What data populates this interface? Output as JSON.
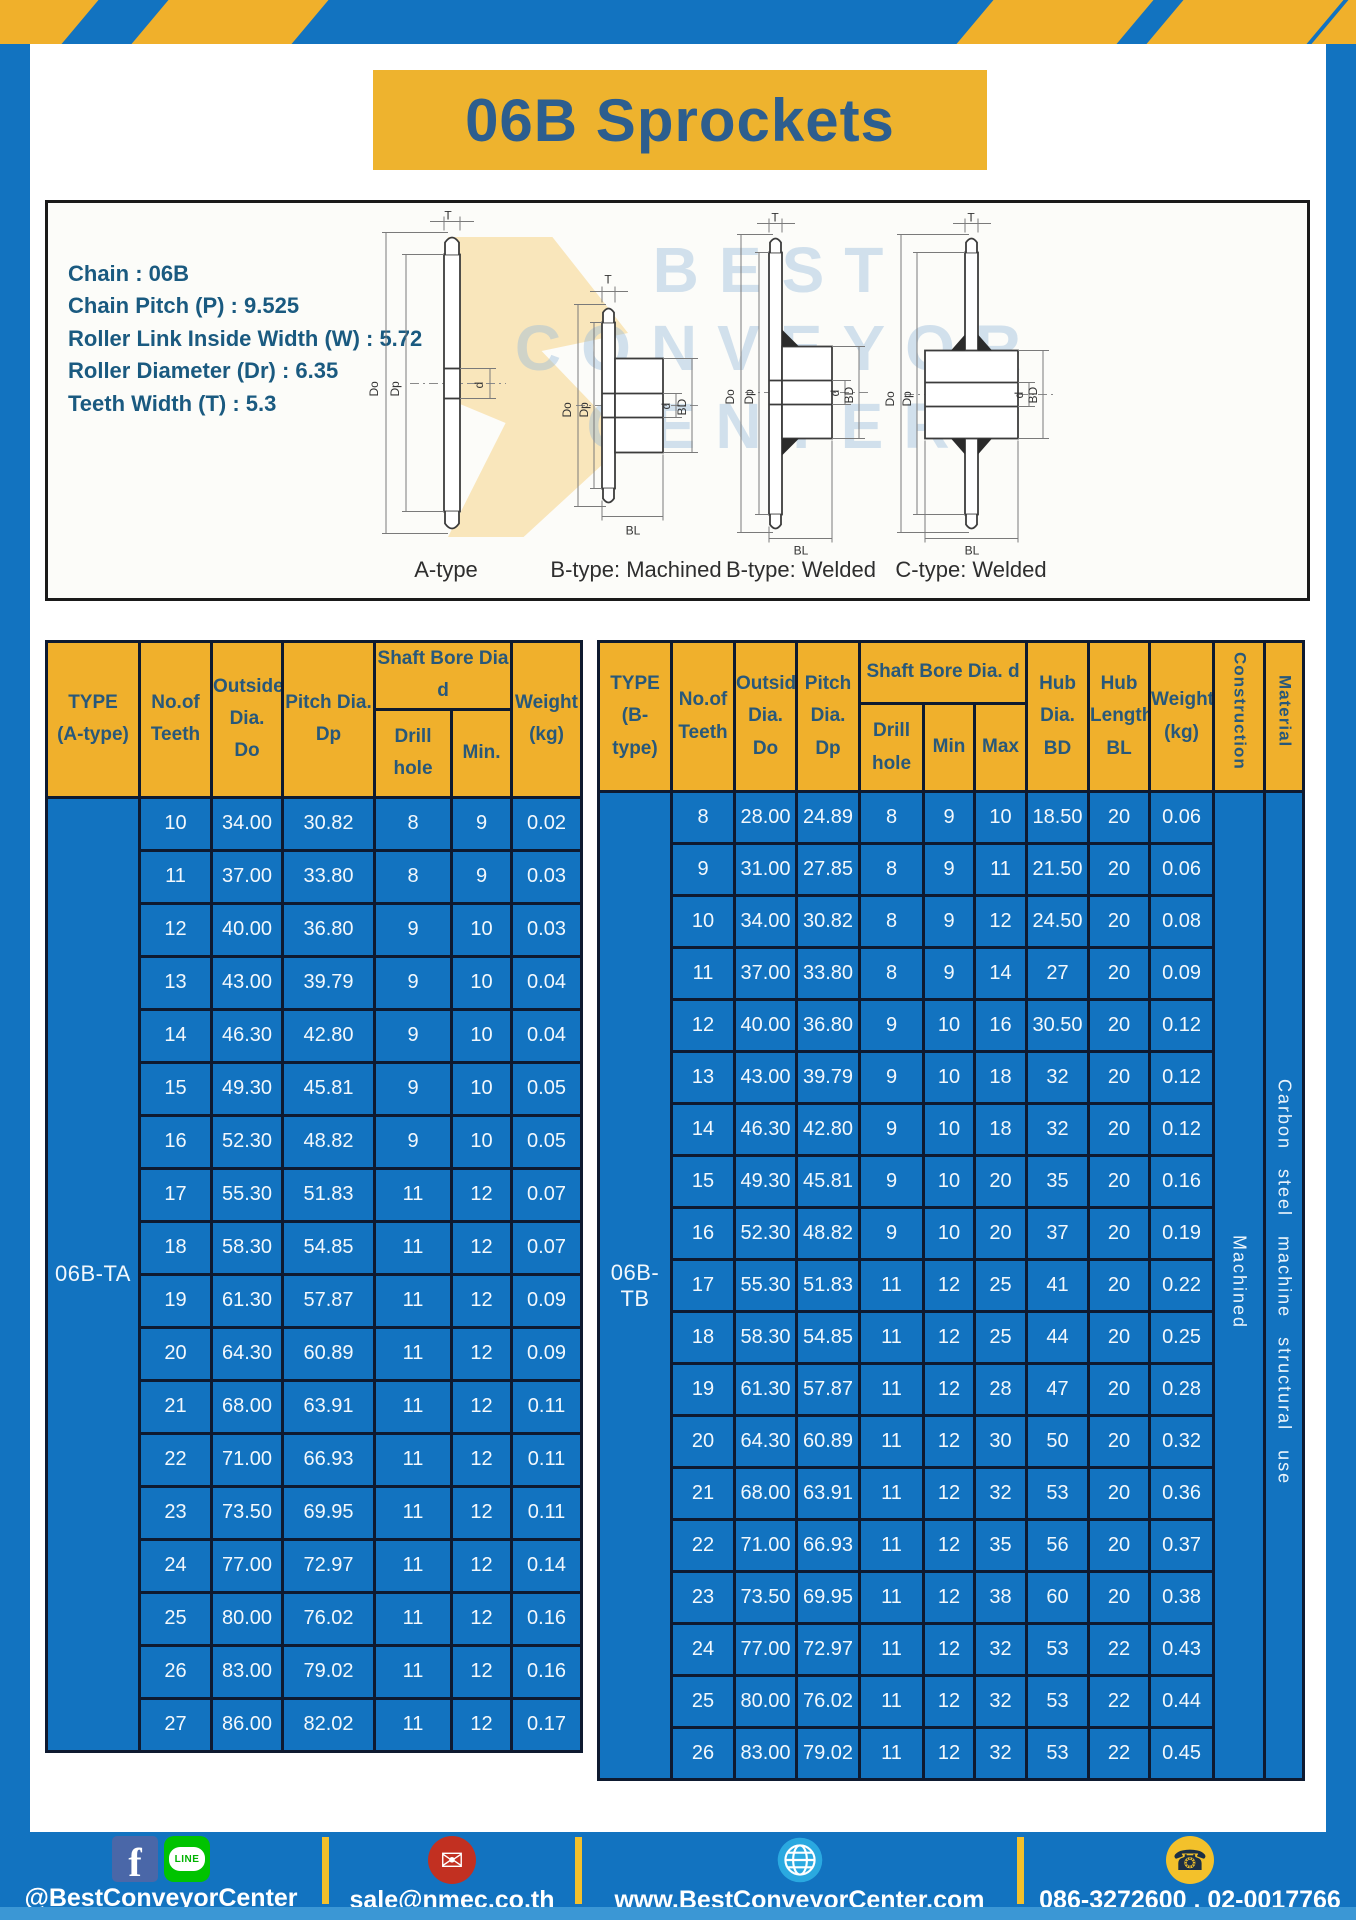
{
  "title": {
    "text": "06B Sprockets"
  },
  "specs": {
    "lines": [
      "Chain : 06B",
      "Chain Pitch (P) : 9.525",
      "Roller Link Inside Width (W) : 5.72",
      "Roller Diameter (Dr) : 6.35",
      "Teeth Width (T) : 5.3"
    ]
  },
  "watermark": {
    "lines": [
      "BEST",
      "CONVEYOR",
      "CENTER"
    ]
  },
  "diagrams": {
    "captions": [
      "A-type",
      "B-type: Machined",
      "B-type: Welded",
      "C-type: Welded"
    ],
    "dim_labels": {
      "t": "T",
      "do": "Do",
      "dp": "Dp",
      "d": "d",
      "bd": "BD",
      "bl": "BL"
    }
  },
  "table_a": {
    "type_label": "06B-TA",
    "headers": {
      "type": "TYPE\n(A-type)",
      "teeth": "No.of\nTeeth",
      "outside": "Outside\nDia.\nDo",
      "pitch": "Pitch Dia.\nDp",
      "shaft": "Shaft Bore Dia d",
      "drill": "Drill hole",
      "min": "Min.",
      "weight": "Weight\n(kg)"
    },
    "rows": [
      [
        "10",
        "34.00",
        "30.82",
        "8",
        "9",
        "0.02"
      ],
      [
        "11",
        "37.00",
        "33.80",
        "8",
        "9",
        "0.03"
      ],
      [
        "12",
        "40.00",
        "36.80",
        "9",
        "10",
        "0.03"
      ],
      [
        "13",
        "43.00",
        "39.79",
        "9",
        "10",
        "0.04"
      ],
      [
        "14",
        "46.30",
        "42.80",
        "9",
        "10",
        "0.04"
      ],
      [
        "15",
        "49.30",
        "45.81",
        "9",
        "10",
        "0.05"
      ],
      [
        "16",
        "52.30",
        "48.82",
        "9",
        "10",
        "0.05"
      ],
      [
        "17",
        "55.30",
        "51.83",
        "11",
        "12",
        "0.07"
      ],
      [
        "18",
        "58.30",
        "54.85",
        "11",
        "12",
        "0.07"
      ],
      [
        "19",
        "61.30",
        "57.87",
        "11",
        "12",
        "0.09"
      ],
      [
        "20",
        "64.30",
        "60.89",
        "11",
        "12",
        "0.09"
      ],
      [
        "21",
        "68.00",
        "63.91",
        "11",
        "12",
        "0.11"
      ],
      [
        "22",
        "71.00",
        "66.93",
        "11",
        "12",
        "0.11"
      ],
      [
        "23",
        "73.50",
        "69.95",
        "11",
        "12",
        "0.11"
      ],
      [
        "24",
        "77.00",
        "72.97",
        "11",
        "12",
        "0.14"
      ],
      [
        "25",
        "80.00",
        "76.02",
        "11",
        "12",
        "0.16"
      ],
      [
        "26",
        "83.00",
        "79.02",
        "11",
        "12",
        "0.16"
      ],
      [
        "27",
        "86.00",
        "82.02",
        "11",
        "12",
        "0.17"
      ]
    ]
  },
  "table_b": {
    "type_label": "06B-TB",
    "construction_value": "Machined",
    "material_value": "Carbon steel machine structural use",
    "headers": {
      "type": "TYPE\n(B-type)",
      "teeth": "No.of\nTeeth",
      "outside": "Outside\nDia.\nDo",
      "pitch": "Pitch\nDia.\nDp",
      "shaft": "Shaft Bore Dia. d",
      "drill": "Drill hole",
      "min": "Min",
      "max": "Max",
      "hub_dia": "Hub\nDia.\nBD",
      "hub_len": "Hub\nLength\nBL",
      "weight": "Weight\n(kg)",
      "construction": "Construction",
      "material": "Material"
    },
    "rows": [
      [
        "8",
        "28.00",
        "24.89",
        "8",
        "9",
        "10",
        "18.50",
        "20",
        "0.06"
      ],
      [
        "9",
        "31.00",
        "27.85",
        "8",
        "9",
        "11",
        "21.50",
        "20",
        "0.06"
      ],
      [
        "10",
        "34.00",
        "30.82",
        "8",
        "9",
        "12",
        "24.50",
        "20",
        "0.08"
      ],
      [
        "11",
        "37.00",
        "33.80",
        "8",
        "9",
        "14",
        "27",
        "20",
        "0.09"
      ],
      [
        "12",
        "40.00",
        "36.80",
        "9",
        "10",
        "16",
        "30.50",
        "20",
        "0.12"
      ],
      [
        "13",
        "43.00",
        "39.79",
        "9",
        "10",
        "18",
        "32",
        "20",
        "0.12"
      ],
      [
        "14",
        "46.30",
        "42.80",
        "9",
        "10",
        "18",
        "32",
        "20",
        "0.12"
      ],
      [
        "15",
        "49.30",
        "45.81",
        "9",
        "10",
        "20",
        "35",
        "20",
        "0.16"
      ],
      [
        "16",
        "52.30",
        "48.82",
        "9",
        "10",
        "20",
        "37",
        "20",
        "0.19"
      ],
      [
        "17",
        "55.30",
        "51.83",
        "11",
        "12",
        "25",
        "41",
        "20",
        "0.22"
      ],
      [
        "18",
        "58.30",
        "54.85",
        "11",
        "12",
        "25",
        "44",
        "20",
        "0.25"
      ],
      [
        "19",
        "61.30",
        "57.87",
        "11",
        "12",
        "28",
        "47",
        "20",
        "0.28"
      ],
      [
        "20",
        "64.30",
        "60.89",
        "11",
        "12",
        "30",
        "50",
        "20",
        "0.32"
      ],
      [
        "21",
        "68.00",
        "63.91",
        "11",
        "12",
        "32",
        "53",
        "20",
        "0.36"
      ],
      [
        "22",
        "71.00",
        "66.93",
        "11",
        "12",
        "35",
        "56",
        "20",
        "0.37"
      ],
      [
        "23",
        "73.50",
        "69.95",
        "11",
        "12",
        "38",
        "60",
        "20",
        "0.38"
      ],
      [
        "24",
        "77.00",
        "72.97",
        "11",
        "12",
        "32",
        "53",
        "22",
        "0.43"
      ],
      [
        "25",
        "80.00",
        "76.02",
        "11",
        "12",
        "32",
        "53",
        "22",
        "0.44"
      ],
      [
        "26",
        "83.00",
        "79.02",
        "11",
        "12",
        "32",
        "53",
        "22",
        "0.45"
      ]
    ]
  },
  "footer": {
    "social_label": "@BestConveyorCenter",
    "email": "sale@nmec.co.th",
    "website": "www.BestConveyorCenter.com",
    "phones": "086-3272600 , 02-0017766",
    "icons": {
      "facebook": "f",
      "line": "LINE",
      "email": "✉",
      "phone": "☎"
    }
  },
  "colors": {
    "frame_blue": "#1273c0",
    "stripe_yellow": "#f0b02b",
    "header_yellow": "#f0b02c",
    "table_blue": "#1273c0",
    "border_navy": "#0e1a30",
    "title_text": "#2d5e8e",
    "footer_accent": "#3b97d5"
  }
}
